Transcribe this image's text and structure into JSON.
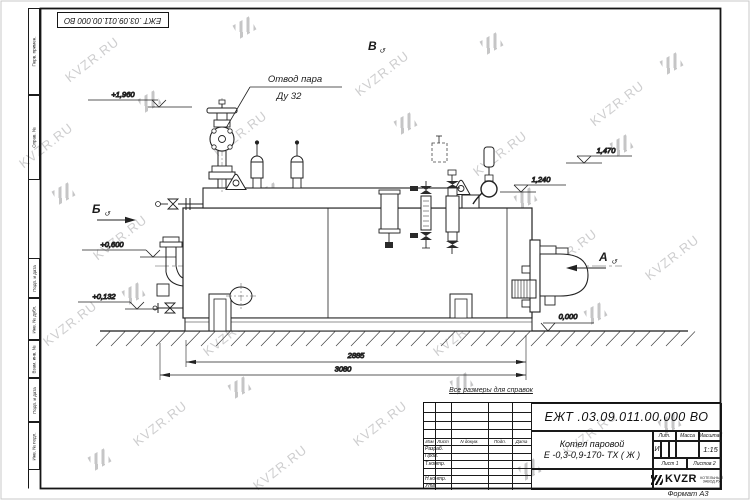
{
  "watermark": {
    "text": "KVZR.RU"
  },
  "frame": {
    "left_boxes": [
      "Перв. примен.",
      "Справ. №",
      "Подп. и дата",
      "Инв. № дубл.",
      "Взам. инв. №",
      "Подп. и дата",
      "Инв. № подл."
    ],
    "format_label": "Формат А3"
  },
  "drawing": {
    "note": "Все размеры для справок",
    "steam_outlet": {
      "line1": "Отвод пара",
      "line2": "Ду 32"
    },
    "views": {
      "top": "В",
      "left": "Б",
      "right": "А",
      "rotated_icon": "↺"
    },
    "elevations": {
      "valve_top": "+1,960",
      "right_high": "1,470",
      "right_mid": "1,240",
      "left_mid": "+0,600",
      "left_low": "+0,132",
      "ground": "0,000"
    },
    "dimensions": {
      "inner": "2885",
      "outer": "3080"
    }
  },
  "title_block": {
    "designation": "ЕЖТ .03.09.011.00.000  ВО",
    "product_line1": "Котел паровой",
    "product_line2": "Е -0,3-0,9-170- ТХ ( Ж )",
    "header_cols": [
      "Изм",
      "Лист",
      "N докум.",
      "Подп.",
      "Дата"
    ],
    "staff_rows": [
      "Разраб.",
      "Пров.",
      "Т.контр.",
      "Н.контр.",
      "Утв."
    ],
    "lit_header": "Лит.",
    "mass_header": "Масса",
    "scale_header": "Масштаб",
    "lit_value": "И",
    "scale_value": "1:15",
    "sheet": "Лист  1",
    "sheets": "Листов  2",
    "logo": "KVZR",
    "logo_sub1": "КОТЕЛЬНЫЙ",
    "logo_sub2": "ЗАВОД.РУ"
  }
}
